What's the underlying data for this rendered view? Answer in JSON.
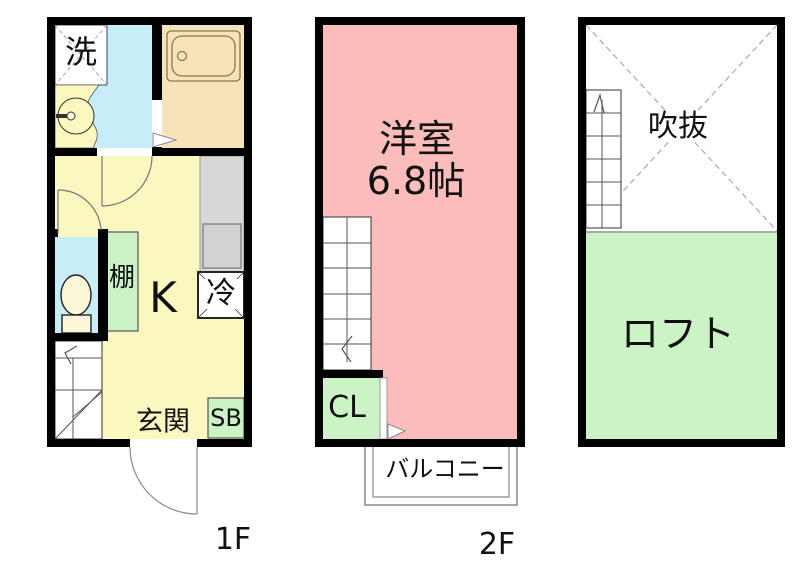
{
  "page": {
    "background": "#FFFFFF"
  },
  "palette": {
    "wall_black": "#000000",
    "kitchen_yellow": "#FAF7BF",
    "bathroom_tan": "#F6E3BA",
    "water_blue": "#C7EDF8",
    "room_pink": "#FBBCBC",
    "storage_green": "#CBF3C6",
    "counter_gray": "#D7D7D7",
    "fixture_cream": "#FCF6D8"
  },
  "floor1": {
    "floor_label": "1F",
    "laundry_label": "洗",
    "shelf_label": "棚",
    "kitchen_label": "K",
    "fridge_label": "冷",
    "entrance_label": "玄関",
    "shoebox_label": "SB"
  },
  "floor2": {
    "floor_label": "2F",
    "room_label": "洋室",
    "room_size_label": "6.8帖",
    "closet_label": "CL",
    "balcony_label": "バルコニー"
  },
  "loft": {
    "void_label": "吹抜",
    "loft_label": "ロフト"
  }
}
